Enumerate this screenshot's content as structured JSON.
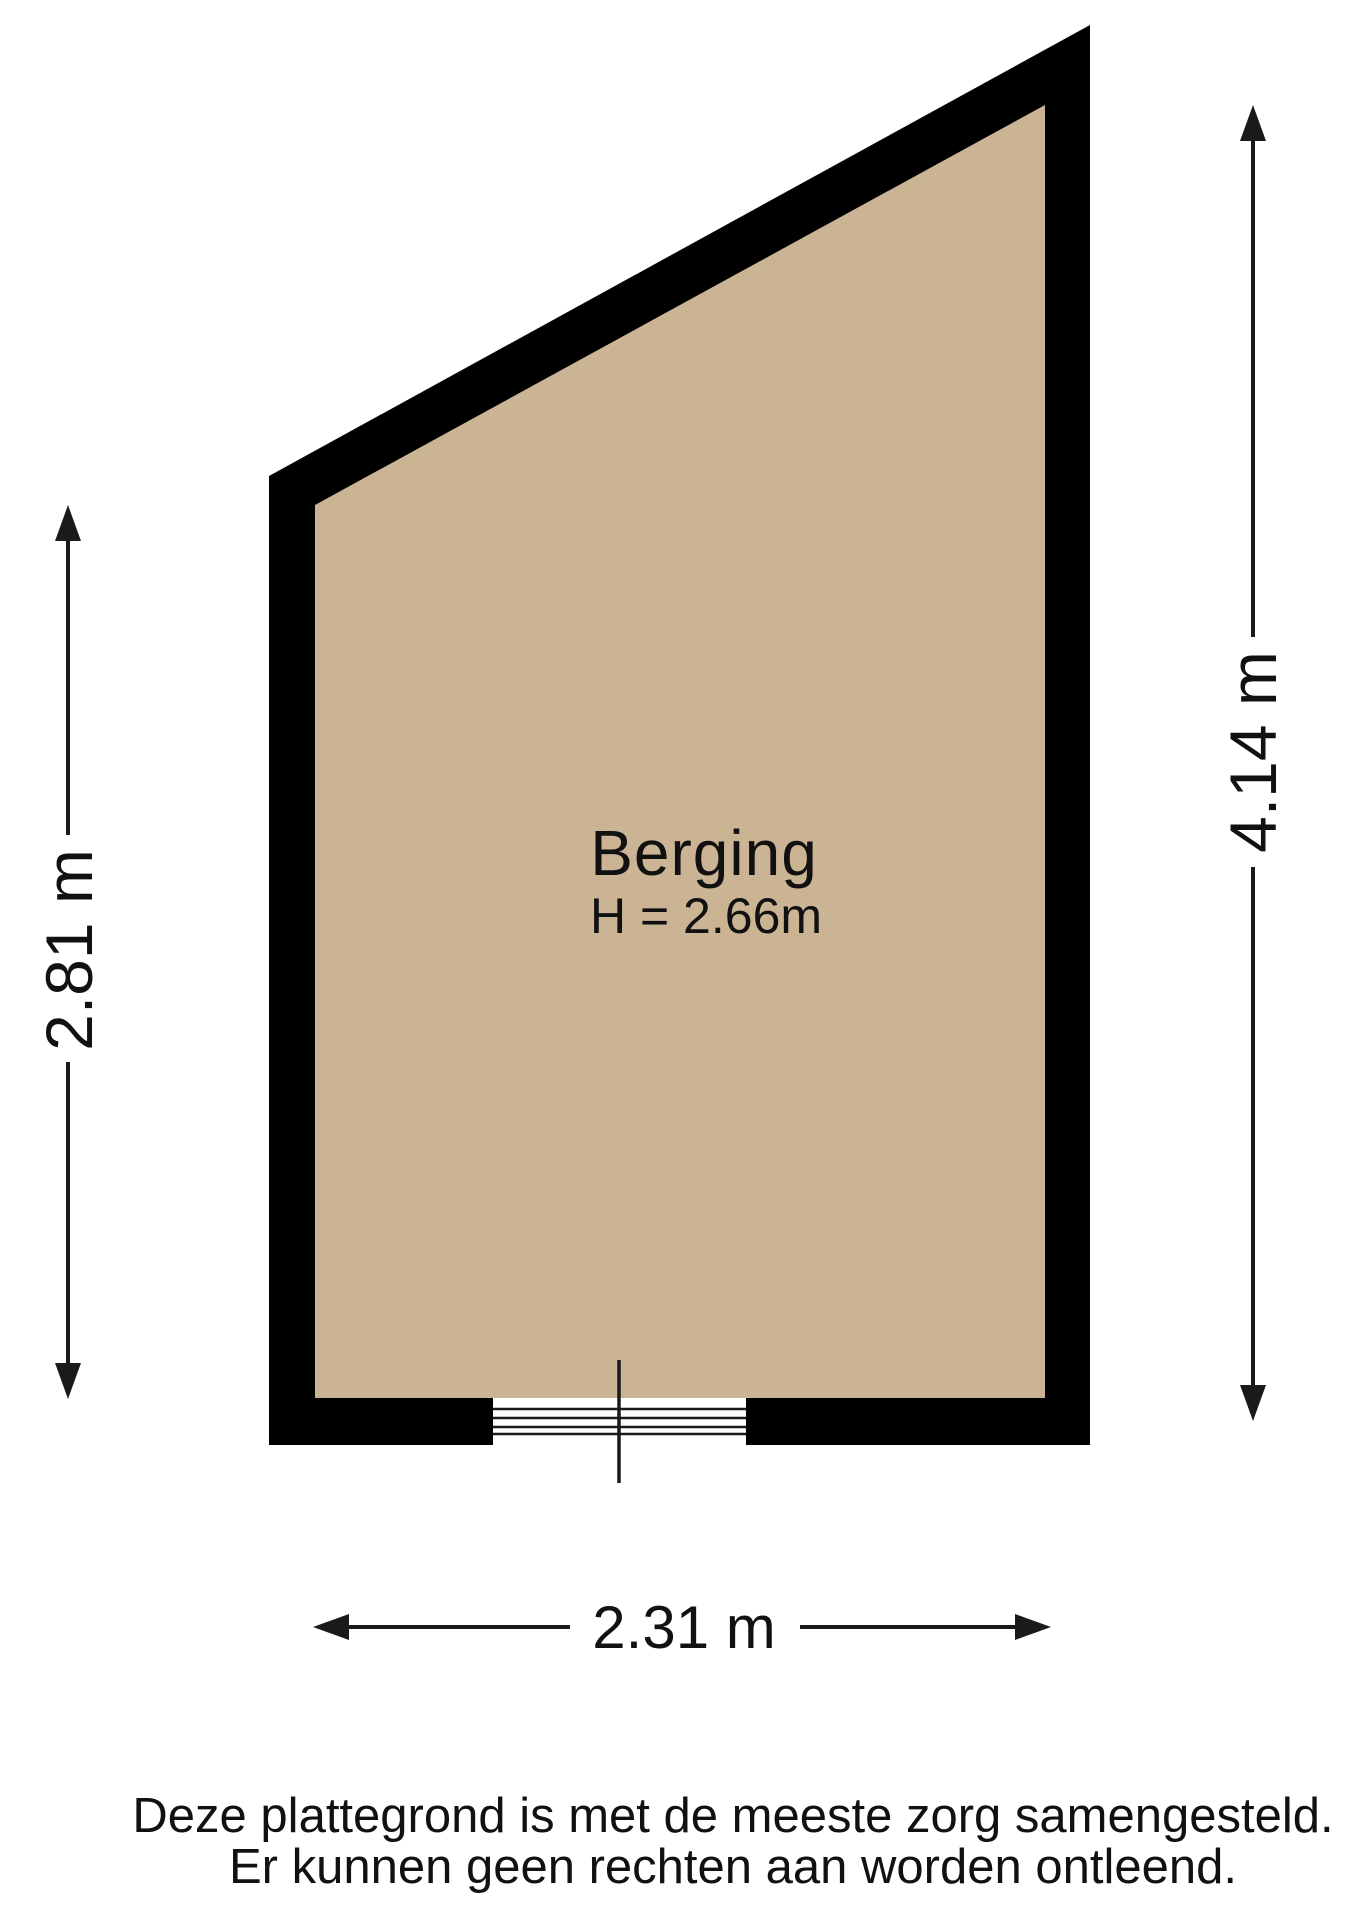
{
  "page": {
    "background": "#ffffff"
  },
  "plan": {
    "room": {
      "label": "Berging",
      "ceiling_height": "H = 2.66m"
    },
    "dimensions": {
      "left_vertical": "2.81 m",
      "right_vertical": "4.14 m",
      "bottom_horizontal": "2.31 m"
    },
    "colors": {
      "floor": "#cab494",
      "wall": "#000000",
      "line": "#1a1a1a",
      "text": "#111111"
    },
    "disclaimer": {
      "line1": "Deze plattegrond is met de meeste zorg samengesteld.",
      "line2": "Er kunnen geen rechten aan worden ontleend."
    }
  }
}
